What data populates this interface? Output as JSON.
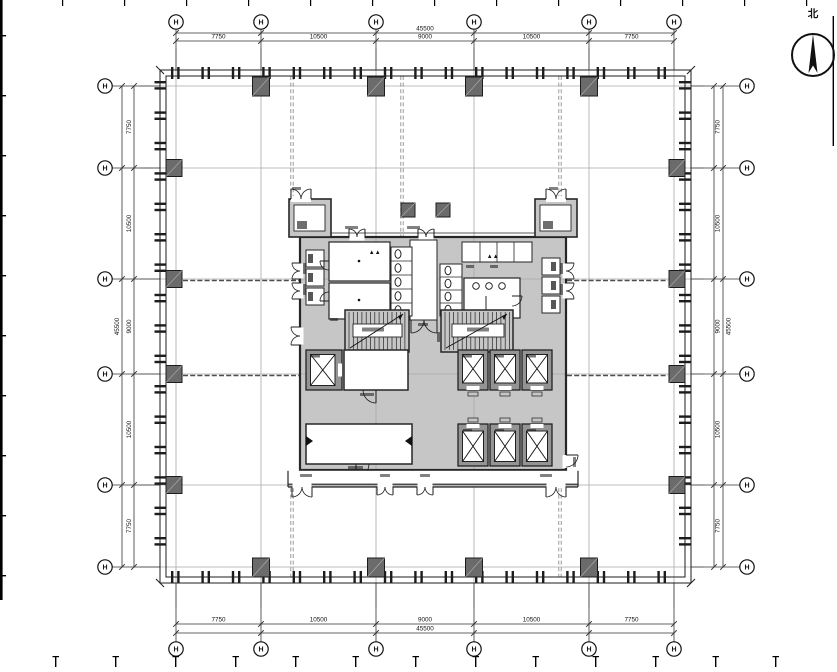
{
  "drawing": {
    "north_label": "北",
    "bubble_label": "H",
    "total_dim": "45500",
    "dims_top": [
      "7750",
      "10500",
      "9000",
      "10500",
      "7750"
    ],
    "dims_bottom": [
      "7750",
      "10500",
      "9000",
      "10500",
      "7750"
    ],
    "dims_left": [
      "7750",
      "10500",
      "9000",
      "10500",
      "7750"
    ],
    "dims_right": [
      "7750",
      "10500",
      "9000",
      "10500",
      "7750"
    ]
  },
  "colors": {
    "line": "#1c1c1c",
    "wall": "#262626",
    "dim": "#333333",
    "grid_line": "#a8a8a8",
    "connector": "#8f8f8f",
    "beam_dash": "#4d4d4d",
    "core_fill": "#c6c6c6",
    "shaft_fill": "#949494",
    "column_fill": "#6b6b6b",
    "white": "#ffffff",
    "smudge": "#1a1a1a"
  }
}
